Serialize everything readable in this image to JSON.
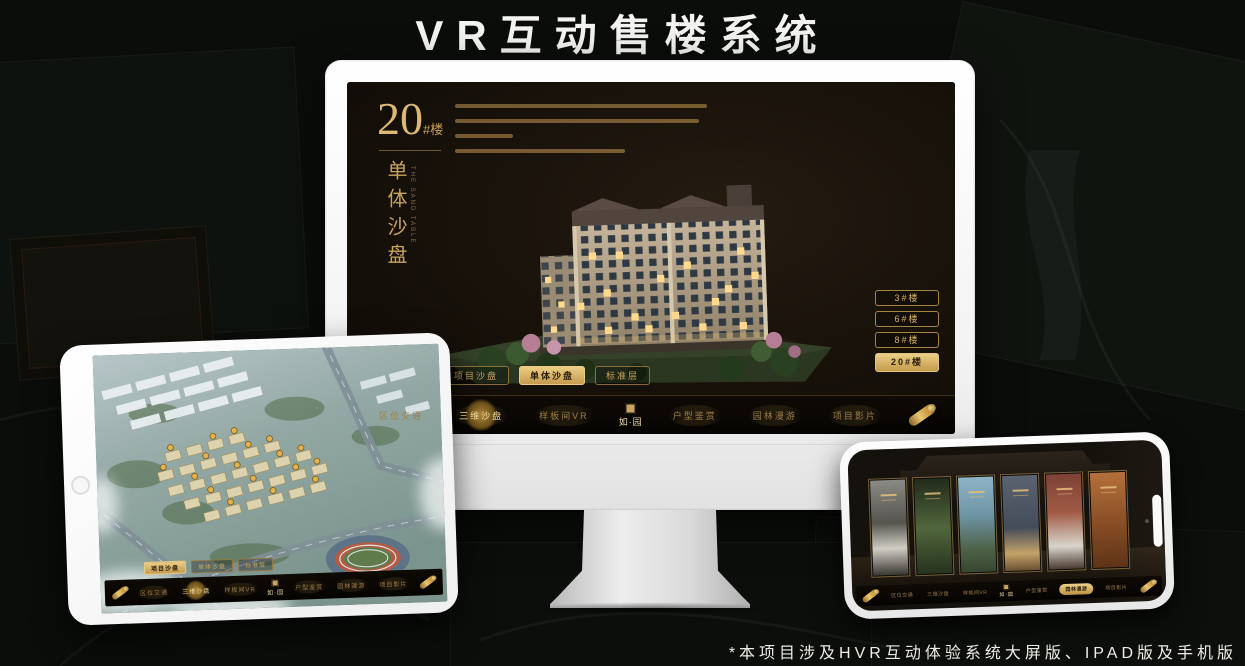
{
  "page": {
    "title": "VR互动售楼系统",
    "footnote": "*本项目涉及HVR互动体验系统大屏版、IPAD版及手机版"
  },
  "colors": {
    "gold": "#C9A257",
    "gold_bright": "#E8CB86",
    "app_background": "#17110A",
    "device_frame": "#F5F5F5"
  },
  "app": {
    "logo": "如·园",
    "nav_items": [
      "区位交通",
      "三维沙盘",
      "样板间VR",
      "户型鉴赏",
      "园林漫游",
      "项目影片"
    ],
    "view_tabs": [
      "项目沙盘",
      "单体沙盘",
      "标准层"
    ]
  },
  "monitor": {
    "heading_number": "20",
    "heading_suffix": "#楼",
    "heading_title": "单体沙盘",
    "heading_subtitle_en": "THE SAND TABLE",
    "floor_buttons": [
      "3#楼",
      "6#楼",
      "8#楼",
      "20#楼"
    ],
    "active_floor": "20#楼",
    "active_view_tab": "单体沙盘",
    "active_nav": "三维沙盘"
  },
  "tablet": {
    "active_view_tab": "项目沙盘",
    "active_nav": "三维沙盘"
  },
  "phone": {
    "active_nav": "园林漫游"
  }
}
